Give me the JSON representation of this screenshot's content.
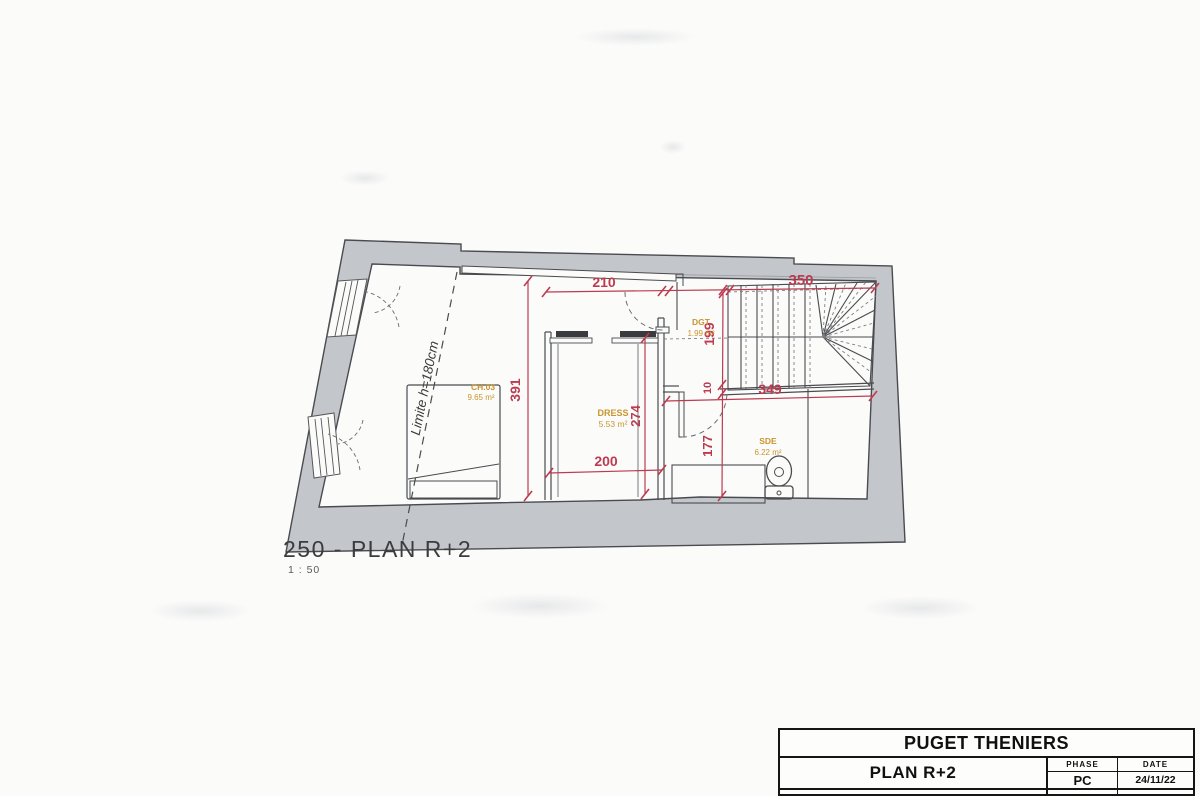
{
  "plan": {
    "number_title": "250 - PLAN R+2",
    "scale": "1 : 50",
    "limit_note": "Limite h=180cm",
    "rooms": {
      "ch03": {
        "name": "CH.03",
        "area": "9.65 m²"
      },
      "dress": {
        "name": "DRESS",
        "area": "5.53 m²"
      },
      "dgt": {
        "name": "DGT",
        "area": "1.99 m²"
      },
      "sde": {
        "name": "SDE",
        "area": "6.22 m²"
      }
    },
    "dimensions": {
      "top_left": "210",
      "top_right": "350",
      "left_height": "391",
      "dgt_height": "199",
      "wall_gap": "10",
      "sde_width": "349",
      "dress_height": "274",
      "sde_height": "177",
      "dress_width": "200"
    }
  },
  "title_block": {
    "project": "PUGET THENIERS",
    "sheet": "PLAN R+2",
    "phase_label": "PHASE",
    "phase_value": "PC",
    "date_label": "DATE",
    "date_value": "24/11/22"
  },
  "colors": {
    "wall_gray": "#c3c6cb",
    "dimension_red": "#bd3b50",
    "room_label_orange": "#c9952f"
  }
}
